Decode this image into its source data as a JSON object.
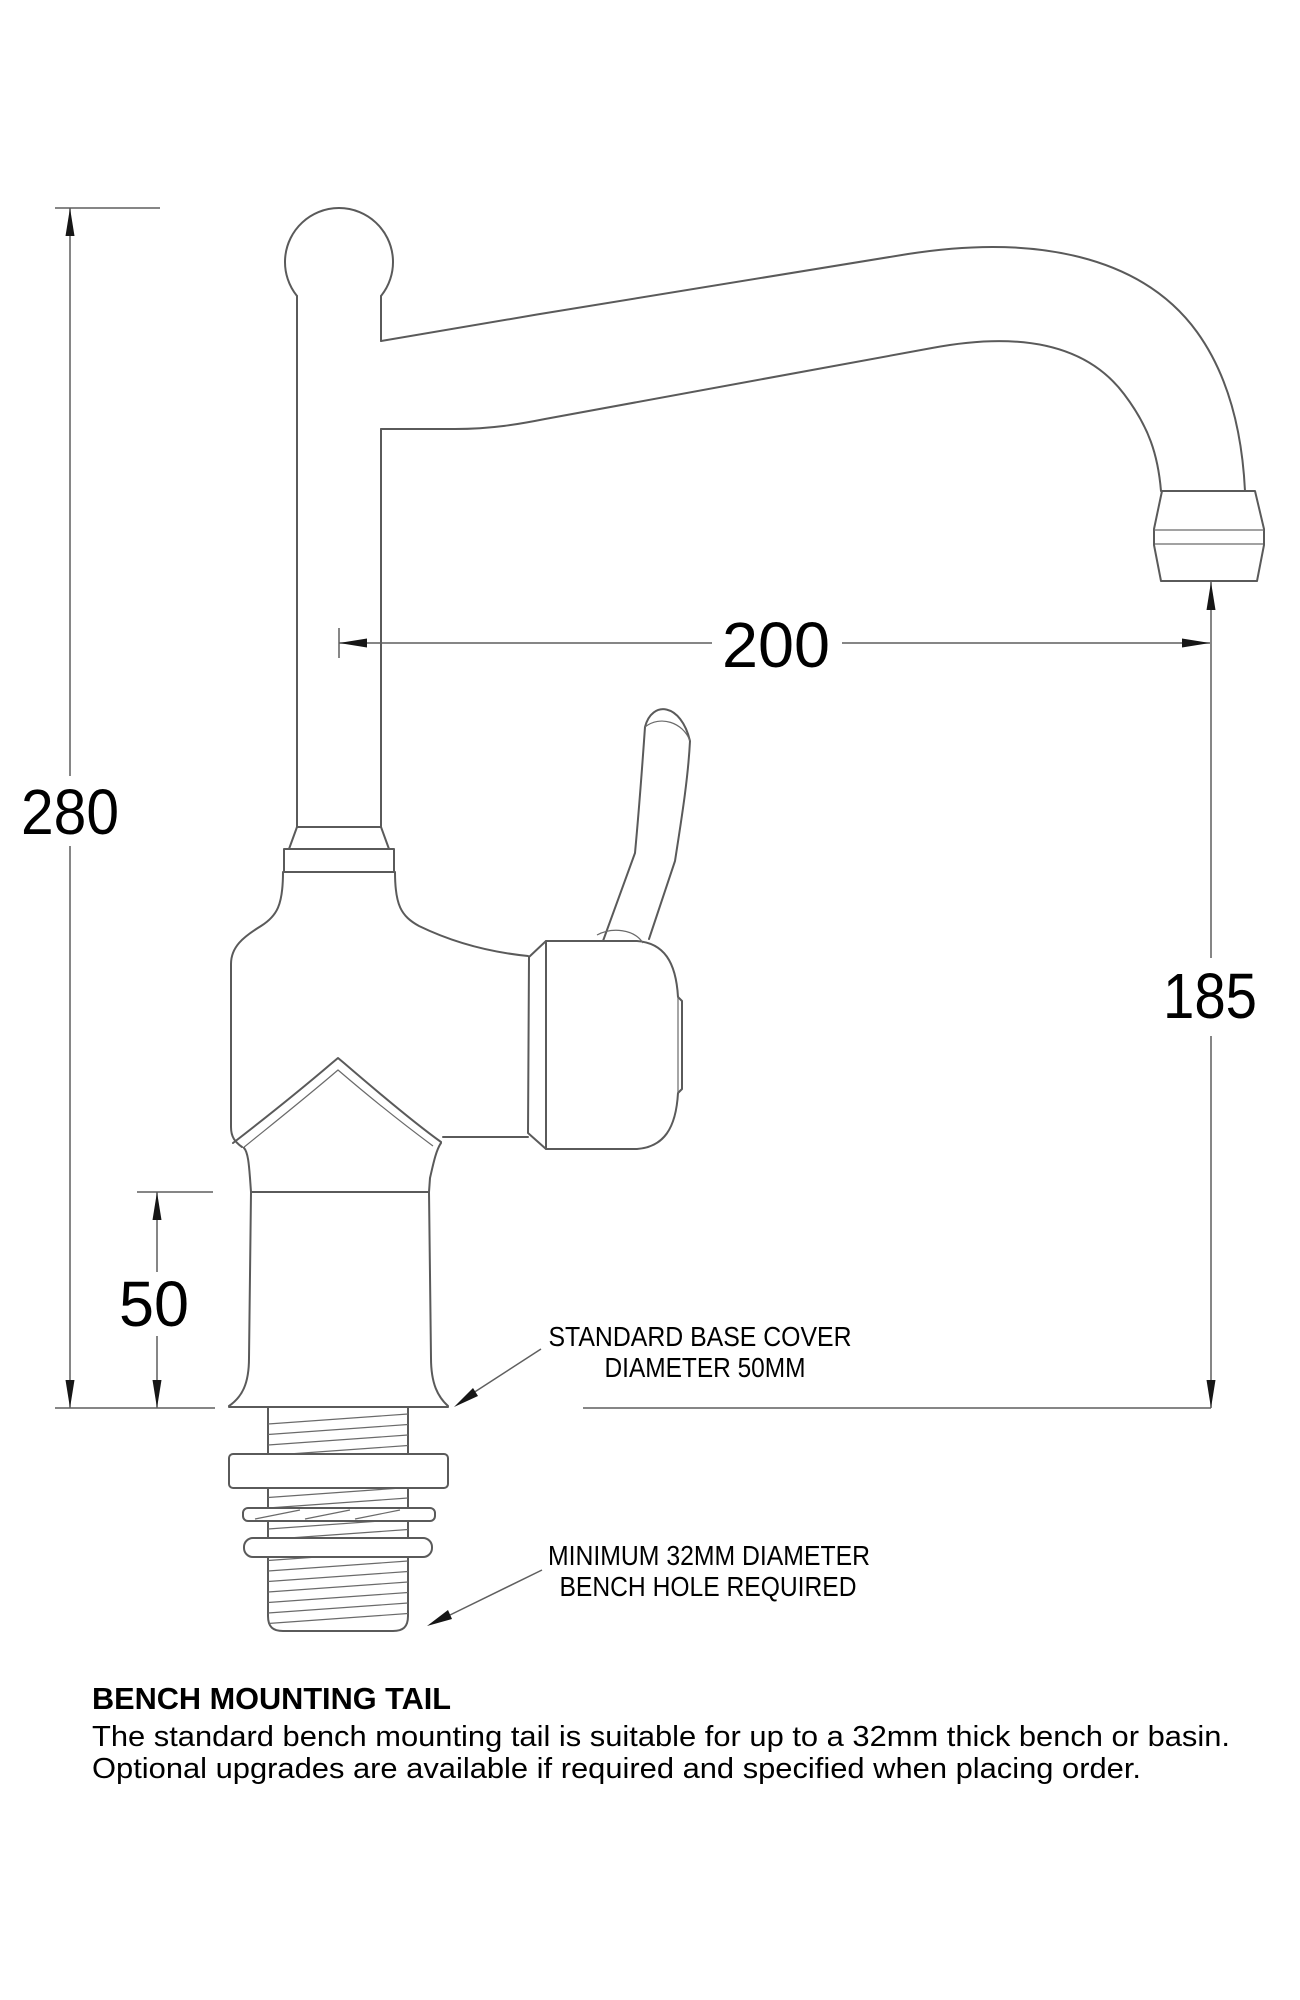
{
  "dimensions": {
    "overall_height": "280",
    "spout_reach": "200",
    "spout_height": "185",
    "base_height": "50"
  },
  "callouts": {
    "base_cover": {
      "line1": "STANDARD BASE COVER",
      "line2": "DIAMETER 50MM"
    },
    "bench_hole": {
      "line1": "MINIMUM 32MM DIAMETER",
      "line2": "BENCH HOLE REQUIRED"
    }
  },
  "notes": {
    "heading": "BENCH MOUNTING TAIL",
    "body_line1": "The standard bench mounting tail is suitable for up to a 32mm thick bench or basin.",
    "body_line2": "Optional upgrades are available if required and specified when placing order."
  },
  "colors": {
    "background": "#ffffff",
    "drawing_line": "#5a5a5a",
    "dimension_line": "#5f5f5f",
    "text": "#000000"
  }
}
